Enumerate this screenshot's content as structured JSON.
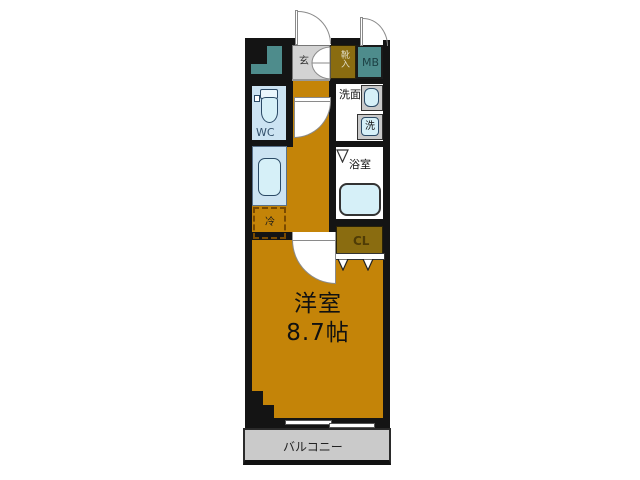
{
  "floorplan": {
    "rooms": {
      "entrance": {
        "label": "玄"
      },
      "shoe_box": {
        "label": "靴入"
      },
      "meter_box": {
        "label": "MB"
      },
      "toilet": {
        "label": "WC"
      },
      "washroom": {
        "label": "洗面"
      },
      "washer": {
        "label": "洗"
      },
      "bathroom": {
        "label": "浴室"
      },
      "closet": {
        "label": "CL"
      },
      "refrigerator": {
        "label": "冷"
      },
      "main_room": {
        "label": "洋室",
        "size": "8.7帖"
      },
      "balcony": {
        "label": "バルコニー"
      }
    }
  },
  "colors": {
    "room_orange": "#C48408",
    "closet_olive": "#8A6C10",
    "meter_teal": "#4E8C8C",
    "fixture_blue": "#CCE3F2",
    "fixture_fill": "#D6F0F8",
    "entrance_gray": "#D3D3D3",
    "balcony_gray": "#CACACA",
    "wall_black": "#141414"
  }
}
